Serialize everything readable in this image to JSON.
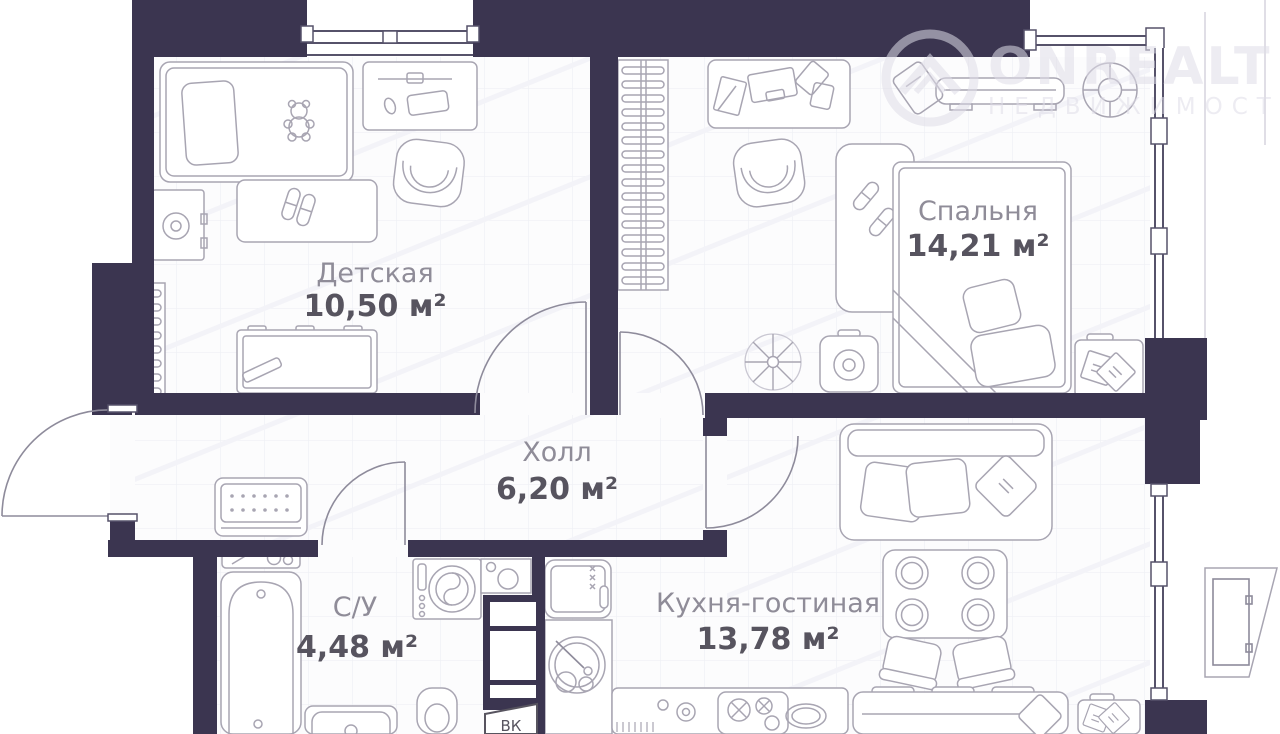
{
  "watermark": {
    "brand": "ONREALT",
    "tagline": "НЕДВИЖИМОСТЬ"
  },
  "rooms": [
    {
      "id": "detskaya",
      "name": "Детская",
      "area": "10,50 м²"
    },
    {
      "id": "spalnya",
      "name": "Спальня",
      "area": "14,21 м²"
    },
    {
      "id": "hall",
      "name": "Холл",
      "area": "6,20 м²"
    },
    {
      "id": "bathroom",
      "name": "С/У",
      "area": "4,48 м²"
    },
    {
      "id": "kitchen",
      "name": "Кухня-гостиная",
      "area": "13,78 м²"
    }
  ],
  "labels": {
    "duct": "ВК"
  },
  "colors": {
    "wall": "#3b3550",
    "floor": "#fcfcfd",
    "furniture_line": "#a8a5b2",
    "window_line": "#56526a",
    "label_name": "#8f8c98",
    "label_area": "#57545f",
    "watermark": "rgba(222,220,232,0.55)"
  }
}
